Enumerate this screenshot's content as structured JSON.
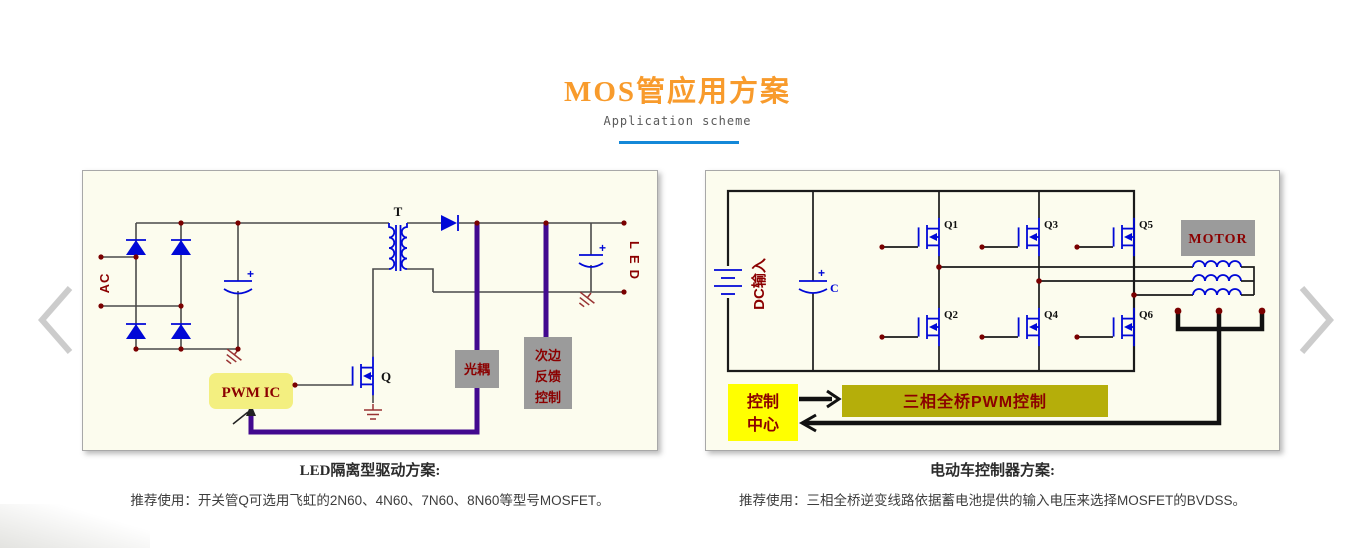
{
  "page": {
    "title": "MOS管应用方案",
    "subtitle": "Application scheme"
  },
  "schemes": [
    {
      "caption": "LED隔离型驱动方案:",
      "description": "推荐使用：开关管Q可选用飞虹的2N60、4N60、7N60、8N60等型号MOSFET。",
      "labels": {
        "ac": "AC",
        "transformer": "T",
        "switch": "Q",
        "pwm_ic": "PWM IC",
        "optocoupler": "光耦",
        "feedback": [
          "次边",
          "反馈",
          "控制"
        ],
        "output": "LED",
        "plus": "+"
      }
    },
    {
      "caption": "电动车控制器方案:",
      "description": "推荐使用：三相全桥逆变线路依据蓄电池提供的输入电压来选择MOSFET的BVDSS。",
      "labels": {
        "dc_input": "DC输入",
        "capacitor": "C",
        "plus": "+",
        "mosfets": [
          "Q1",
          "Q2",
          "Q3",
          "Q4",
          "Q5",
          "Q6"
        ],
        "motor": "MOTOR",
        "control_center": [
          "控制",
          "中心"
        ],
        "pwm_control": "三相全桥PWM控制"
      }
    }
  ],
  "colors": {
    "title_orange": "#F89B2C",
    "underline_blue": "#1488D8",
    "panel_bg": "#FCFCEE",
    "schematic_blue": "#0008D7",
    "label_dark_red": "#8B0000",
    "junction_dot": "#7A0000",
    "optocoupler_box_gray": "#9B9B9B",
    "pwm_ic_yellow": "#F3EF80",
    "control_center_yellow": "#FFFF00",
    "pwm_bar_olive": "#B5AE0A",
    "feedback_purple": "#42098F",
    "arrow_gray": "#CCCCCC"
  }
}
